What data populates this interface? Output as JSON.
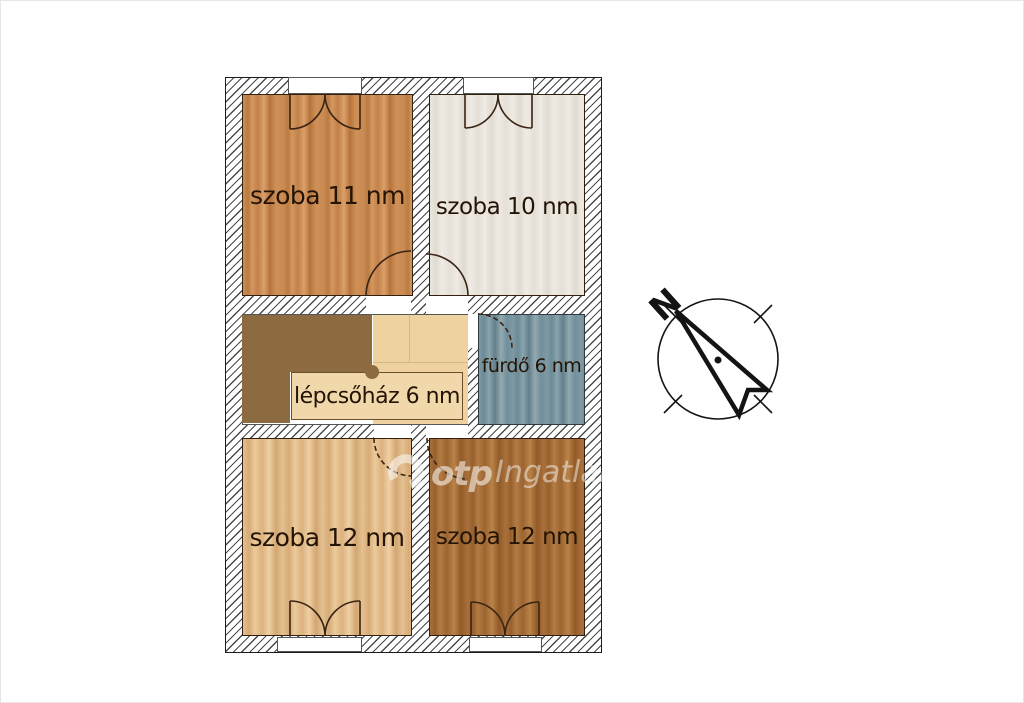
{
  "floor_plan": {
    "rooms": [
      {
        "name": "szoba-11",
        "label": "szoba 11 nm",
        "area_sqm": 11
      },
      {
        "name": "szoba-10",
        "label": "szoba 10 nm",
        "area_sqm": 10
      },
      {
        "name": "lepcsohaz",
        "label": "lépcsőház 6 nm",
        "area_sqm": 6
      },
      {
        "name": "furdo",
        "label": "fürdő 6 nm",
        "area_sqm": 6
      },
      {
        "name": "szoba-12-left",
        "label": "szoba 12 nm",
        "area_sqm": 12
      },
      {
        "name": "szoba-12-right",
        "label": "szoba 12 nm",
        "area_sqm": 12
      }
    ],
    "floor_colors": {
      "szoba_11": "#cb8e55",
      "szoba_10": "#ebe7df",
      "lepcsohaz_floor": "#eed2a0",
      "stairwell_block": "#8d6b40",
      "furdo": "#7e99a3",
      "szoba_12_left": "#e3bf8e",
      "szoba_12_right": "#a8703b",
      "wall_hatch_line": "#4a4a4a"
    }
  },
  "compass": {
    "north_label": "N"
  },
  "watermark": {
    "brand": "otp",
    "suffix": "Ingatlan"
  }
}
